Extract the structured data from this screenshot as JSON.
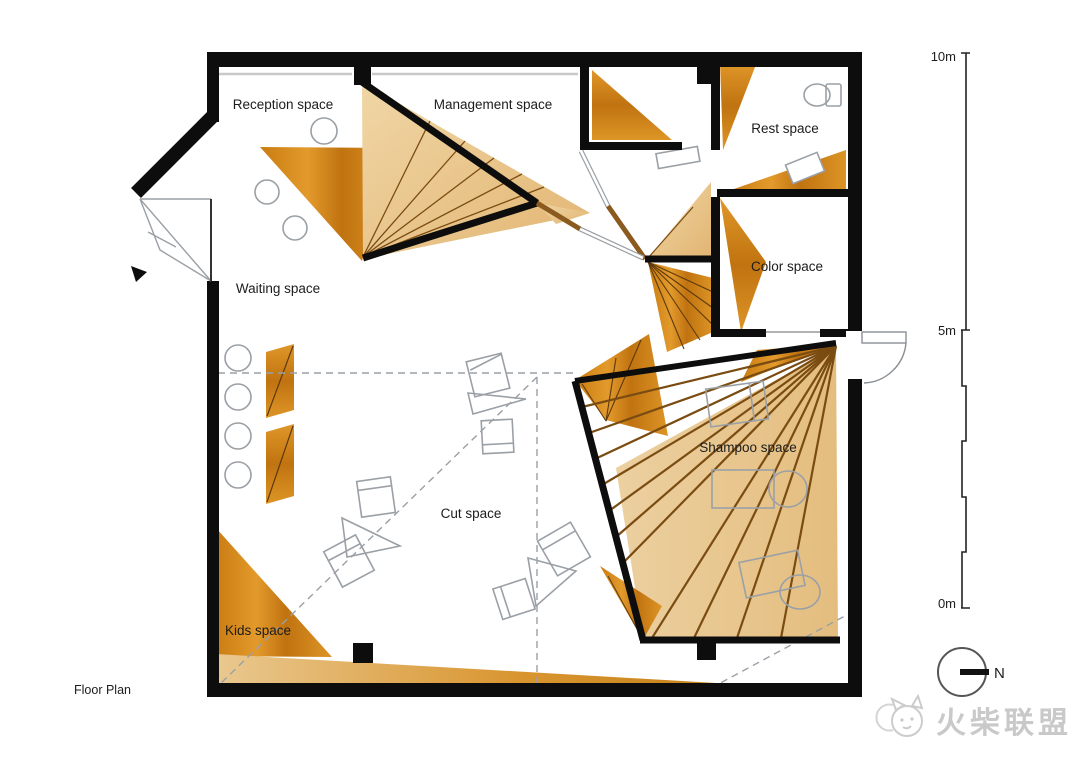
{
  "plan": {
    "caption": "Floor Plan",
    "labels": {
      "reception": "Reception space",
      "management": "Management space",
      "rest": "Rest space",
      "color": "Color space",
      "waiting": "Waiting space",
      "shampoo": "Shampoo space",
      "cut": "Cut space",
      "kids": "Kids space"
    }
  },
  "scale_bar": {
    "top": "10m",
    "middle": "5m",
    "bottom": "0m"
  },
  "compass": {
    "label": "N"
  },
  "watermark": {
    "text": "火柴联盟"
  },
  "colors": {
    "wall_black": "#0d0d0d",
    "wood_dark": "#d8901f",
    "wood_dark_deep": "#b96d0c",
    "wood_tan": "#e9c88f",
    "wood_tan_light": "#f0d8ab",
    "fan_line_brown": "#7a4c12",
    "stick_brown": "#8a5a1e",
    "furniture_gray": "#9aa0a6",
    "watermark_gray": "#c9c9c9"
  }
}
